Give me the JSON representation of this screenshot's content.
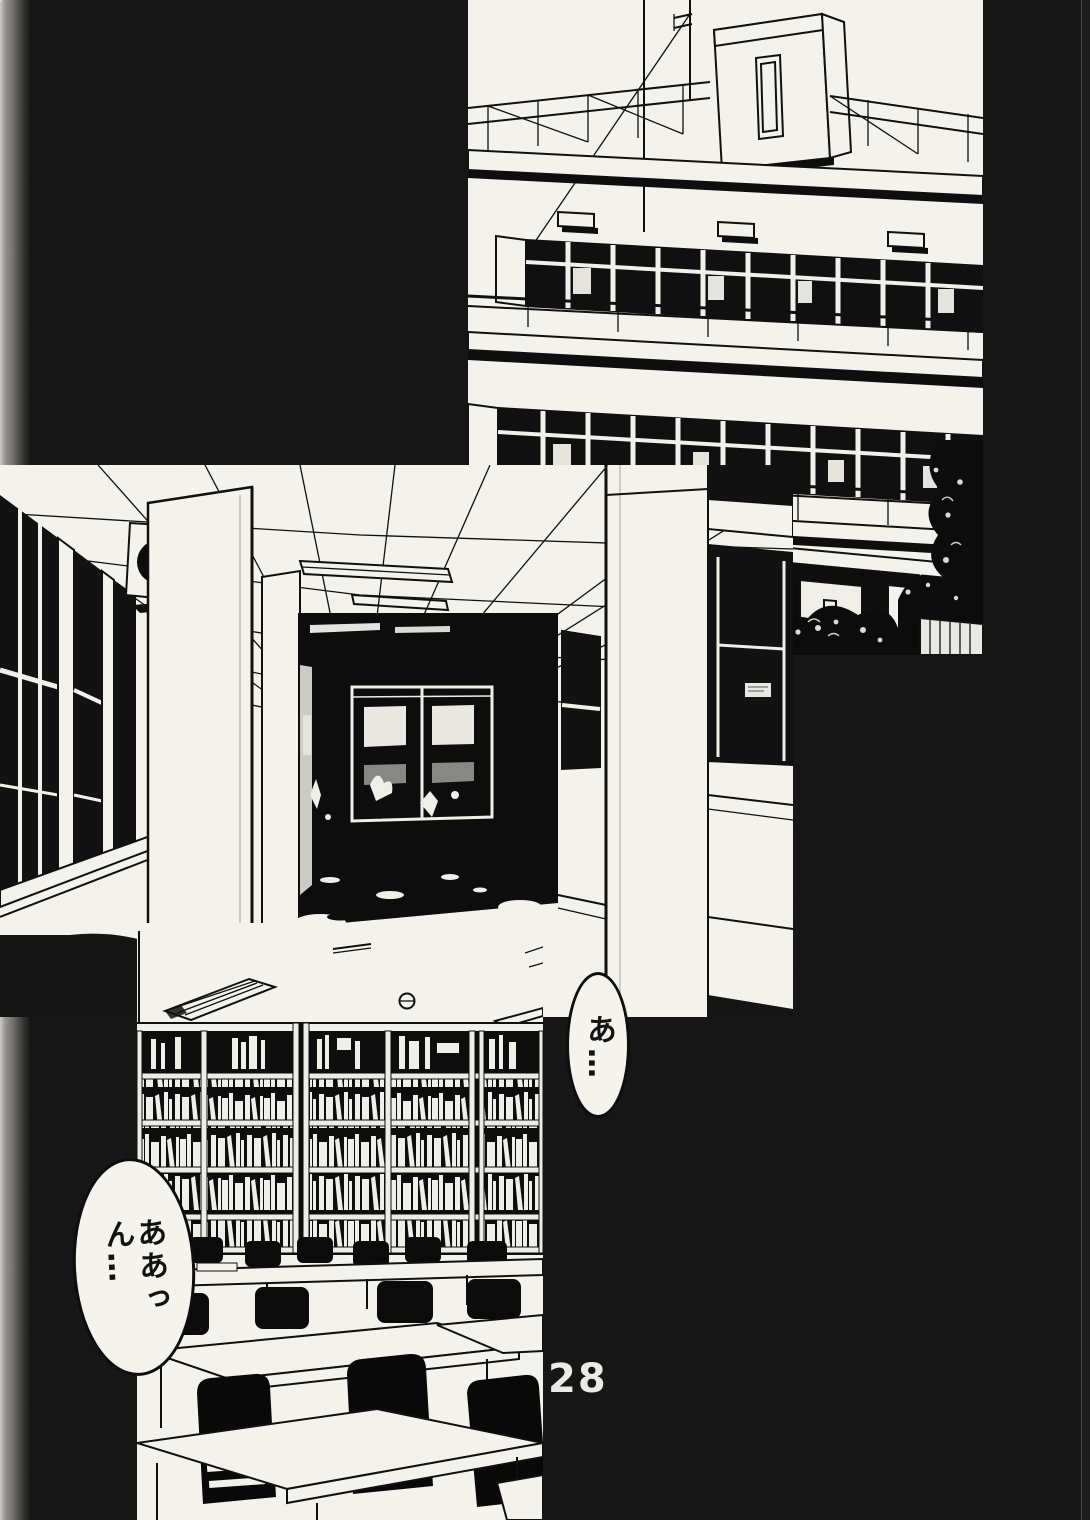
{
  "page": {
    "number": "28"
  },
  "speech": {
    "bubble_small": {
      "text": "あ…"
    },
    "bubble_large": {
      "col_right": "ああっ",
      "col_left": "ん…"
    }
  },
  "panels": {
    "top": {
      "name": "school-building-exterior"
    },
    "middle": {
      "name": "school-hallway"
    },
    "bottom": {
      "name": "library-interior"
    }
  },
  "colors": {
    "paper": "#f3f2ec",
    "ink": "#111111",
    "page_bg": "#161616",
    "binding_gray": "#8d8b88",
    "page_number_white": "#eceae6"
  }
}
